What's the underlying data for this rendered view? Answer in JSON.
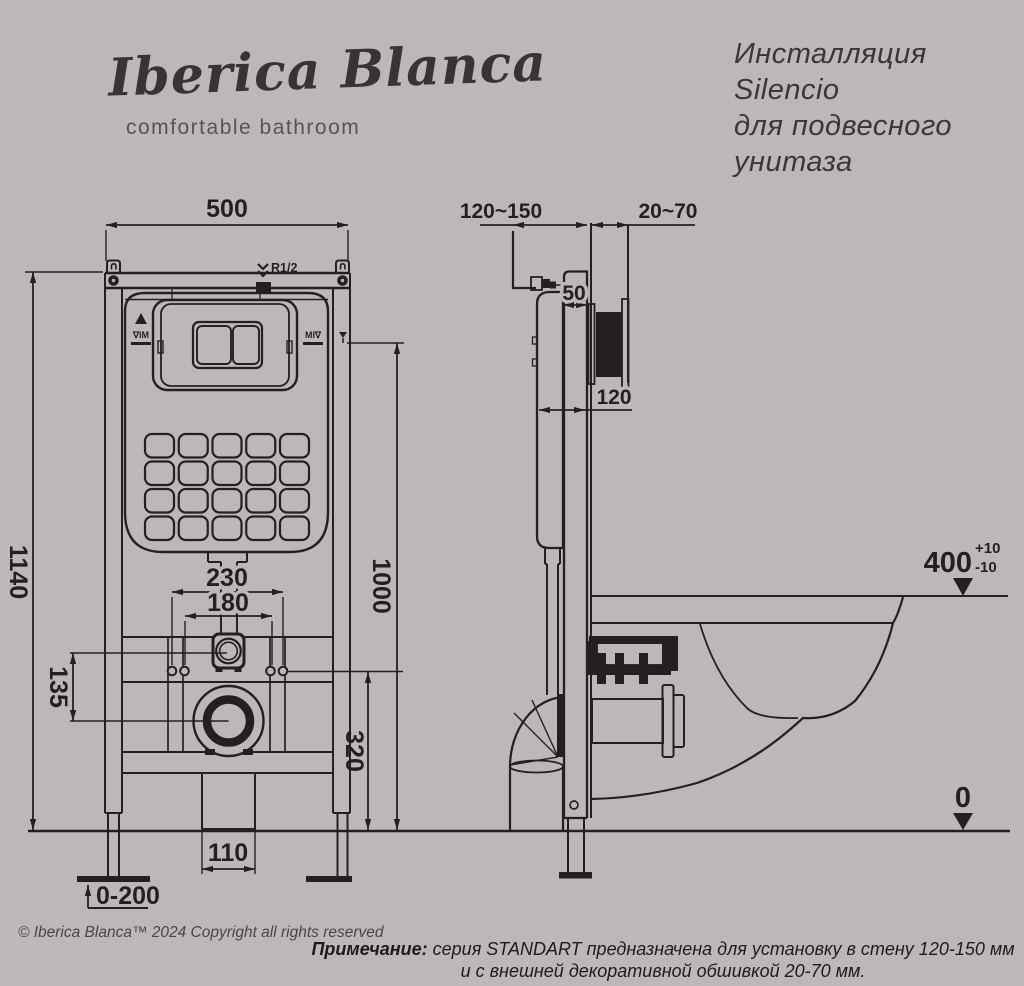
{
  "page": {
    "background": "#bdb8b8",
    "ink": "#241f21"
  },
  "brand": {
    "name": "Iberica Blanca",
    "tagline": "comfortable bathroom"
  },
  "product_title": {
    "lines": [
      "Инсталляция",
      "Silencio",
      "для подвесного",
      "унитаза"
    ]
  },
  "front_view": {
    "dim_frame_width": "500",
    "dim_frame_height": "1140",
    "dim_flush_pipe_height": "1000",
    "dim_rod_spacing_outer": "230",
    "dim_rod_spacing_inner": "180",
    "dim_inlet_to_drain": "135",
    "dim_drain_axis_height": "320",
    "dim_outlet_width": "110",
    "dim_foot_adjust_range": "0-200",
    "inlet_thread": "R1/2",
    "level_mark": "∇IM"
  },
  "side_view": {
    "dim_install_depth": "120~150",
    "dim_cladding_thickness": "20~70",
    "dim_frame_depth": "50",
    "dim_tank_depth": "120",
    "dim_rim_height": "400",
    "tol_plus": "+10",
    "tol_minus": "-10",
    "dim_floor_level": "0"
  },
  "footer": {
    "copyright": "© Iberica Blanca™ 2024 Copyright all rights reserved",
    "note_label": "Примечание:",
    "note_text1": "серия STANDART предназначена для установку в стену 120-150 мм",
    "note_text2": "и с внешней декоративной обшивкой 20-70 мм."
  }
}
